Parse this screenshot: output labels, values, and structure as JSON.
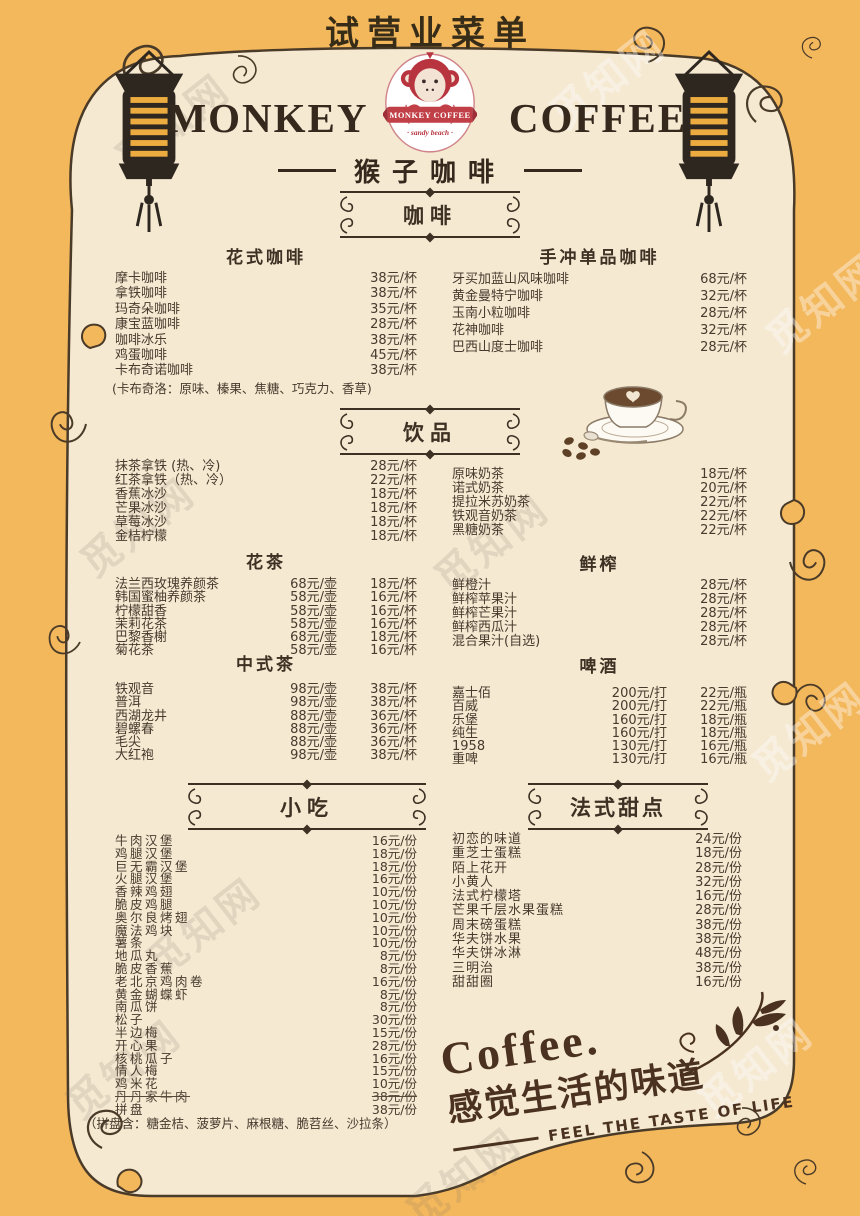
{
  "page": {
    "title": "试营业菜单",
    "watermark": "觅知网"
  },
  "brand": {
    "name_left": "MONKEY",
    "name_right": "COFFEE",
    "logo_banner": "MONKEY COFFEE",
    "logo_sub": "· sandy beach ·",
    "subtitle": "猴子咖啡"
  },
  "colors": {
    "background_orange": "#F3B75C",
    "paper_cream": "#F5E9D2",
    "ink": "#3C3123",
    "logo_red": "#C13F47"
  },
  "menu": {
    "coffee_header": "咖啡",
    "fancy": {
      "subheader": "花式咖啡",
      "items": [
        {
          "name": "摩卡咖啡",
          "prices": [
            "38元/杯"
          ]
        },
        {
          "name": "拿铁咖啡",
          "prices": [
            "38元/杯"
          ]
        },
        {
          "name": "玛奇朵咖啡",
          "prices": [
            "35元/杯"
          ]
        },
        {
          "name": "康宝蓝咖啡",
          "prices": [
            "28元/杯"
          ]
        },
        {
          "name": "咖啡冰乐",
          "prices": [
            "38元/杯"
          ]
        },
        {
          "name": "鸡蛋咖啡",
          "prices": [
            "45元/杯"
          ]
        },
        {
          "name": "卡布奇诺咖啡",
          "prices": [
            "38元/杯"
          ]
        }
      ],
      "note": "(卡布奇洛：原味、榛果、焦糖、巧克力、香草)"
    },
    "single_origin": {
      "subheader": "手冲单品咖啡",
      "items": [
        {
          "name": "牙买加蓝山风味咖啡",
          "prices": [
            "68元/杯"
          ]
        },
        {
          "name": "黄金曼特宁咖啡",
          "prices": [
            "32元/杯"
          ]
        },
        {
          "name": "玉南小粒咖啡",
          "prices": [
            "28元/杯"
          ]
        },
        {
          "name": "花神咖啡",
          "prices": [
            "32元/杯"
          ]
        },
        {
          "name": "巴西山度士咖啡",
          "prices": [
            "28元/杯"
          ]
        }
      ]
    },
    "drinks_header": "饮品",
    "drinks_left": {
      "items": [
        {
          "name": "抹茶拿铁 (热、冷)",
          "prices": [
            "28元/杯"
          ]
        },
        {
          "name": "红茶拿铁（热、冷）",
          "prices": [
            "22元/杯"
          ]
        },
        {
          "name": "香蕉冰沙",
          "prices": [
            "18元/杯"
          ]
        },
        {
          "name": "芒果冰沙",
          "prices": [
            "18元/杯"
          ]
        },
        {
          "name": "草莓冰沙",
          "prices": [
            "18元/杯"
          ]
        },
        {
          "name": "金桔柠檬",
          "prices": [
            "18元/杯"
          ]
        }
      ]
    },
    "milk_tea": {
      "items": [
        {
          "name": "原味奶茶",
          "prices": [
            "18元/杯"
          ]
        },
        {
          "name": "诺式奶茶",
          "prices": [
            "20元/杯"
          ]
        },
        {
          "name": "提拉米苏奶茶",
          "prices": [
            "22元/杯"
          ]
        },
        {
          "name": "铁观音奶茶",
          "prices": [
            "22元/杯"
          ]
        },
        {
          "name": "黑糖奶茶",
          "prices": [
            "22元/杯"
          ]
        }
      ]
    },
    "flower_tea": {
      "subheader": "花茶",
      "items": [
        {
          "name": "法兰西玫瑰养颜茶",
          "prices": [
            "68元/壶",
            "18元/杯"
          ]
        },
        {
          "name": "韩国蜜柚养颜茶",
          "prices": [
            "58元/壶",
            "16元/杯"
          ]
        },
        {
          "name": "柠檬甜香",
          "prices": [
            "58元/壶",
            "16元/杯"
          ]
        },
        {
          "name": "茉莉花茶",
          "prices": [
            "58元/壶",
            "16元/杯"
          ]
        },
        {
          "name": "巴黎香榭",
          "prices": [
            "68元/壶",
            "18元/杯"
          ]
        },
        {
          "name": "菊花茶",
          "prices": [
            "58元/壶",
            "16元/杯"
          ]
        }
      ]
    },
    "juice": {
      "subheader": "鲜榨",
      "items": [
        {
          "name": "鲜橙汁",
          "prices": [
            "28元/杯"
          ]
        },
        {
          "name": "鲜榨苹果汁",
          "prices": [
            "28元/杯"
          ]
        },
        {
          "name": "鲜榨芒果汁",
          "prices": [
            "28元/杯"
          ]
        },
        {
          "name": "鲜榨西瓜汁",
          "prices": [
            "28元/杯"
          ]
        },
        {
          "name": "混合果汁(自选)",
          "prices": [
            "28元/杯"
          ]
        }
      ]
    },
    "chinese_tea": {
      "subheader": "中式茶",
      "items": [
        {
          "name": "铁观音",
          "prices": [
            "98元/壶",
            "38元/杯"
          ]
        },
        {
          "name": "普洱",
          "prices": [
            "98元/壶",
            "38元/杯"
          ]
        },
        {
          "name": "西湖龙井",
          "prices": [
            "88元/壶",
            "36元/杯"
          ]
        },
        {
          "name": "碧螺春",
          "prices": [
            "88元/壶",
            "36元/杯"
          ]
        },
        {
          "name": "毛尖",
          "prices": [
            "88元/壶",
            "36元/杯"
          ]
        },
        {
          "name": "大红袍",
          "prices": [
            "98元/壶",
            "38元/杯"
          ]
        }
      ]
    },
    "beer": {
      "subheader": "啤酒",
      "items": [
        {
          "name": "嘉士佰",
          "prices": [
            "200元/打",
            "22元/瓶"
          ]
        },
        {
          "name": "百威",
          "prices": [
            "200元/打",
            "22元/瓶"
          ]
        },
        {
          "name": "乐堡",
          "prices": [
            "160元/打",
            "18元/瓶"
          ]
        },
        {
          "name": "纯生",
          "prices": [
            "160元/打",
            "18元/瓶"
          ]
        },
        {
          "name": "1958",
          "prices": [
            "130元/打",
            "16元/瓶"
          ]
        },
        {
          "name": "重啤",
          "prices": [
            "130元/打",
            "16元/瓶"
          ]
        }
      ]
    },
    "snacks_header": "小吃",
    "snacks": {
      "items": [
        {
          "name": "牛肉汉堡",
          "prices": [
            "16元/份"
          ]
        },
        {
          "name": "鸡腿汉堡",
          "prices": [
            "18元/份"
          ]
        },
        {
          "name": "巨无霸汉堡",
          "prices": [
            "18元/份"
          ]
        },
        {
          "name": "火腿汉堡",
          "prices": [
            "16元/份"
          ]
        },
        {
          "name": "香辣鸡翅",
          "prices": [
            "10元/份"
          ]
        },
        {
          "name": "脆皮鸡腿",
          "prices": [
            "10元/份"
          ]
        },
        {
          "name": "奥尔良烤翅",
          "prices": [
            "10元/份"
          ]
        },
        {
          "name": "魔法鸡块",
          "prices": [
            "10元/份"
          ]
        },
        {
          "name": "薯条",
          "prices": [
            "10元/份"
          ]
        },
        {
          "name": "地瓜丸",
          "prices": [
            "8元/份"
          ]
        },
        {
          "name": "脆皮香蕉",
          "prices": [
            "8元/份"
          ]
        },
        {
          "name": "老北京鸡肉卷",
          "prices": [
            "16元/份"
          ]
        },
        {
          "name": "黄金蝴蝶虾",
          "prices": [
            "8元/份"
          ]
        },
        {
          "name": "南瓜饼",
          "prices": [
            "8元/份"
          ]
        },
        {
          "name": "松子",
          "prices": [
            "30元/份"
          ]
        },
        {
          "name": "半边梅",
          "prices": [
            "15元/份"
          ]
        },
        {
          "name": "开心果",
          "prices": [
            "28元/份"
          ]
        },
        {
          "name": "核桃瓜子",
          "prices": [
            "16元/份"
          ]
        },
        {
          "name": "情人梅",
          "prices": [
            "15元/份"
          ]
        },
        {
          "name": "鸡米花",
          "prices": [
            "10元/份"
          ]
        },
        {
          "name": "丹丹家牛肉",
          "prices": [
            "38元/份"
          ],
          "struck": true
        },
        {
          "name": "拼盘",
          "prices": [
            "38元/份"
          ]
        }
      ],
      "note": "（拼盘含：糖金桔、菠萝片、麻根糖、脆苕丝、沙拉条）"
    },
    "desserts_header": "法式甜点",
    "desserts": {
      "items": [
        {
          "name": "初恋的味道",
          "prices": [
            "24元/份"
          ]
        },
        {
          "name": "重芝士蛋糕",
          "prices": [
            "18元/份"
          ]
        },
        {
          "name": "陌上花开",
          "prices": [
            "28元/份"
          ]
        },
        {
          "name": "小黄人",
          "prices": [
            "32元/份"
          ]
        },
        {
          "name": "法式柠檬塔",
          "prices": [
            "16元/份"
          ]
        },
        {
          "name": "芒果千层水果蛋糕",
          "prices": [
            "28元/份"
          ]
        },
        {
          "name": "周末磅蛋糕",
          "prices": [
            "38元/份"
          ]
        },
        {
          "name": "华夫饼水果",
          "prices": [
            "38元/份"
          ]
        },
        {
          "name": "华夫饼冰淋",
          "prices": [
            "48元/份"
          ]
        },
        {
          "name": "三明治",
          "prices": [
            "38元/份"
          ]
        },
        {
          "name": "甜甜圈",
          "prices": [
            "16元/份"
          ]
        }
      ]
    }
  },
  "footer": {
    "coffee_word": "Coffee.",
    "slogan_cn": "感觉生活的味道",
    "slogan_en": "FEEL THE TASTE OF LIFE"
  }
}
